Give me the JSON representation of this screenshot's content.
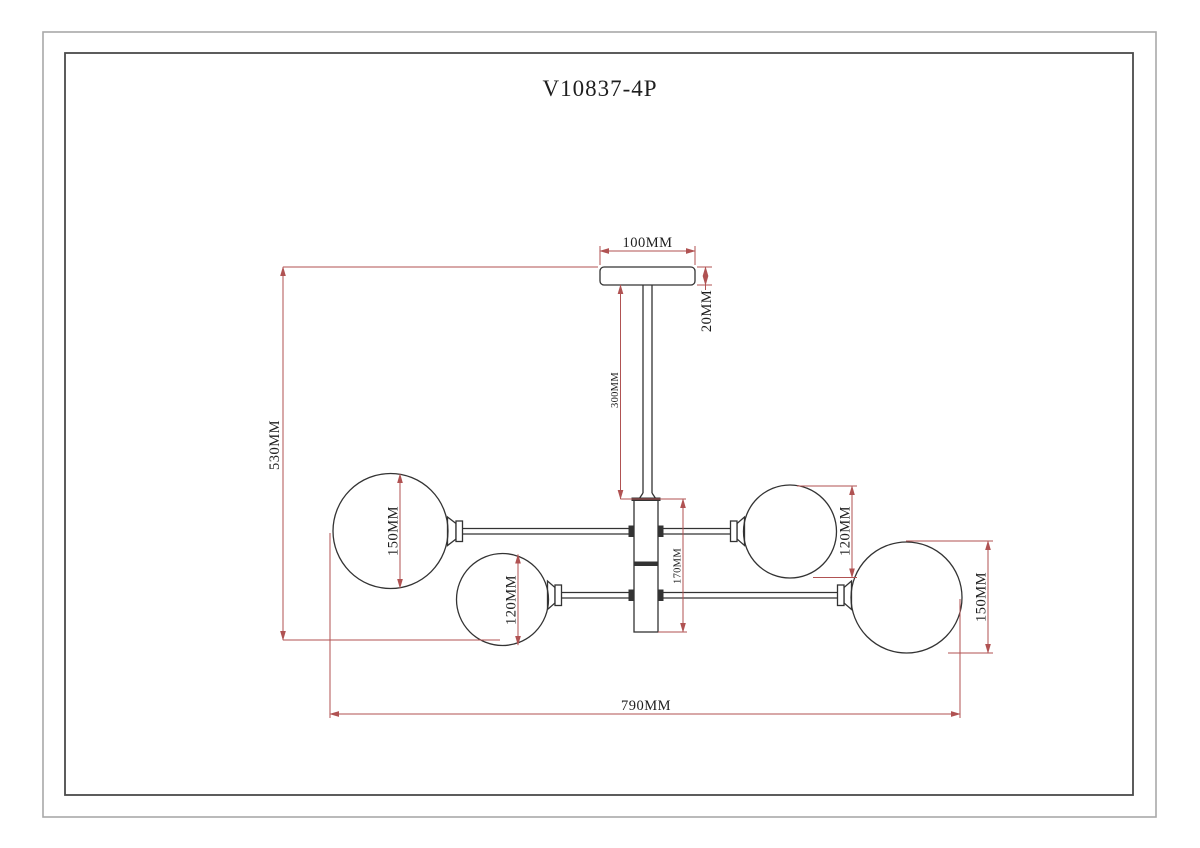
{
  "title": "V10837-4P",
  "colors": {
    "dimension_line": "#b05252",
    "drawing_line": "#333333",
    "frame_outer": "#a8a8a8",
    "frame_inner": "#4a4a4a"
  },
  "dimensions": {
    "canopy_width": "100MM",
    "canopy_height": "20MM",
    "rod_length": "300MM",
    "overall_height": "530MM",
    "hub_height": "170MM",
    "globe_large_left": "150MM",
    "globe_small_left": "120MM",
    "globe_small_right": "120MM",
    "globe_large_right": "150MM",
    "overall_width": "790MM"
  }
}
